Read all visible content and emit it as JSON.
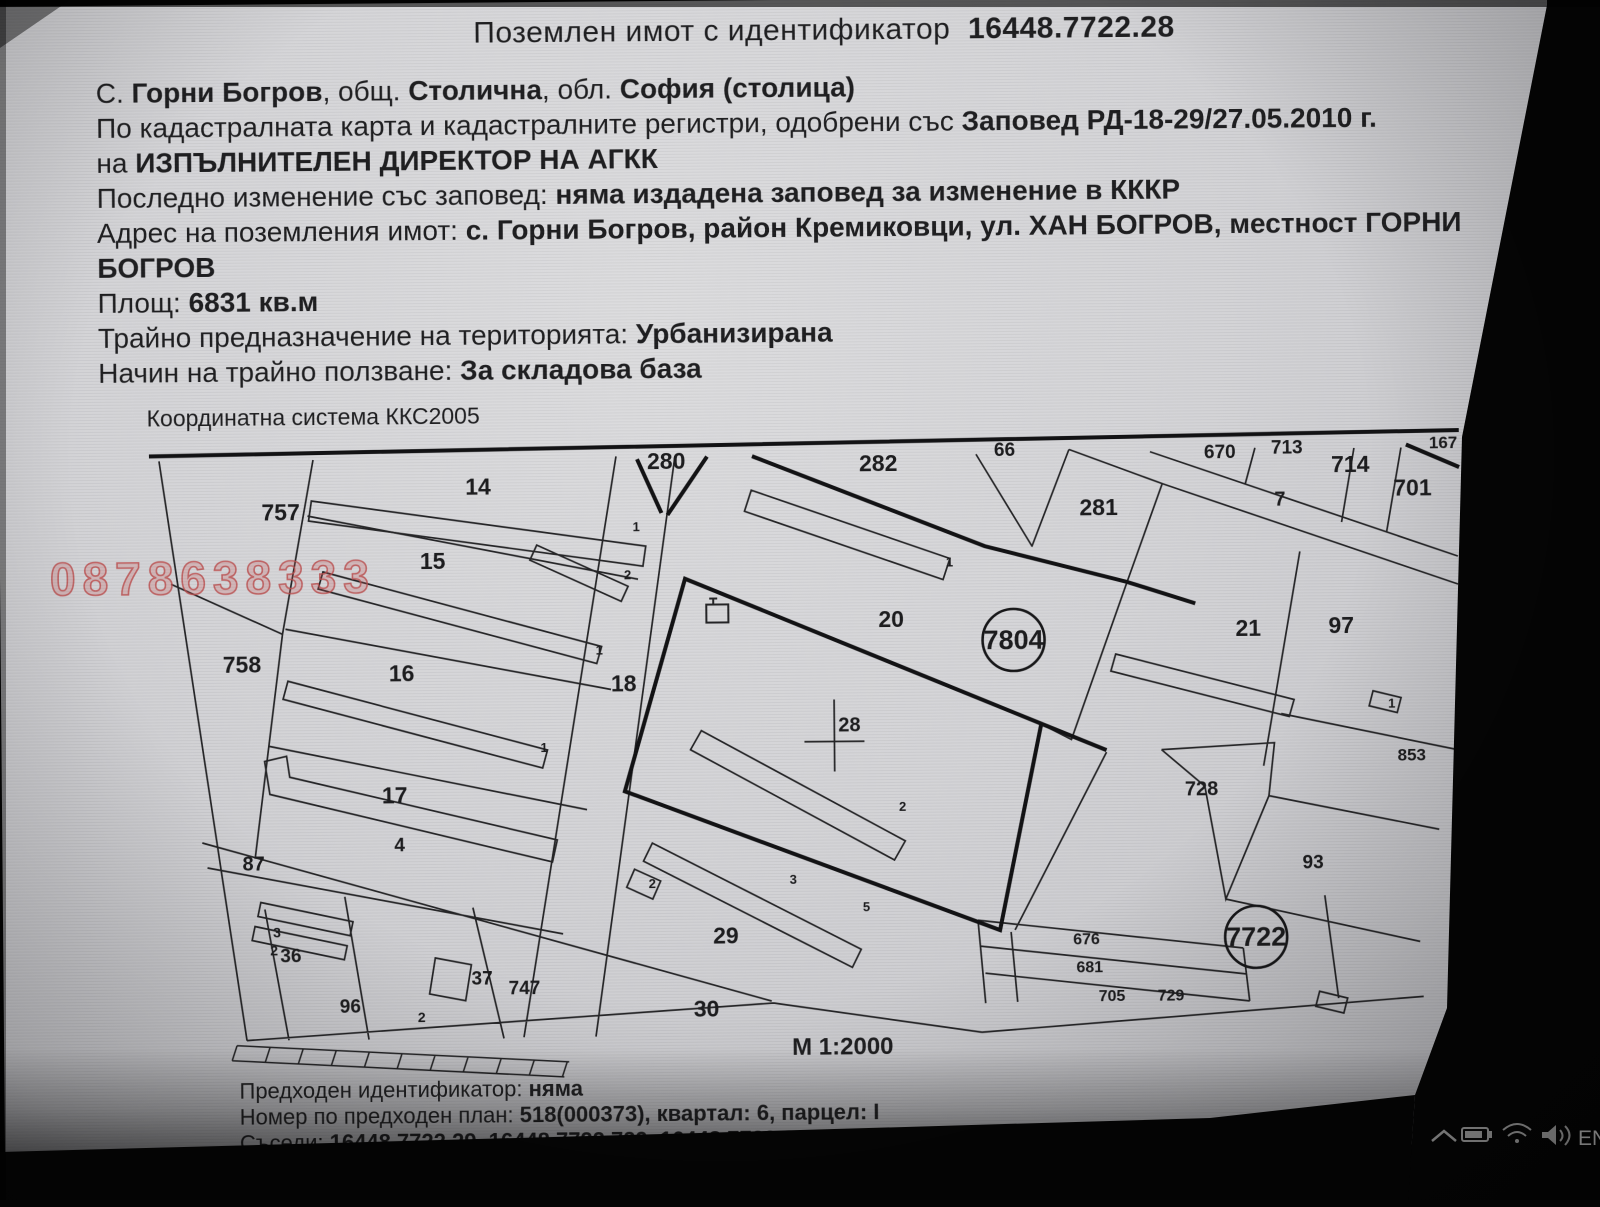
{
  "title": {
    "prefix": "Поземлен имот с  идентификатор",
    "id": "16448.7722.28"
  },
  "header": {
    "lines": [
      {
        "parts": [
          {
            "text": "С. ",
            "bold": false
          },
          {
            "text": "Горни Богров",
            "bold": true
          },
          {
            "text": ", общ. ",
            "bold": false
          },
          {
            "text": "Столична",
            "bold": true
          },
          {
            "text": ", обл. ",
            "bold": false
          },
          {
            "text": "София (столица)",
            "bold": true
          }
        ]
      },
      {
        "parts": [
          {
            "text": "По кадастралната карта и кадастралните регистри, одобрени със ",
            "bold": false
          },
          {
            "text": "Заповед РД-18-29/27.05.2010 г.",
            "bold": true
          }
        ]
      },
      {
        "parts": [
          {
            "text": "на ",
            "bold": false
          },
          {
            "text": "ИЗПЪЛНИТЕЛЕН ДИРЕКТОР НА АГКК",
            "bold": true
          }
        ]
      },
      {
        "parts": [
          {
            "text": "Последно изменение със заповед: ",
            "bold": false
          },
          {
            "text": "няма издадена заповед за изменение в КККР",
            "bold": true
          }
        ]
      },
      {
        "parts": [
          {
            "text": "Адрес на поземления имот: ",
            "bold": false
          },
          {
            "text": "с. Горни Богров, район Кремиковци, ул. ХАН БОГРОВ, местност ГОРНИ",
            "bold": true
          }
        ]
      },
      {
        "parts": [
          {
            "text": "БОГРОВ",
            "bold": true
          }
        ]
      },
      {
        "parts": [
          {
            "text": "Площ: ",
            "bold": false
          },
          {
            "text": "6831 кв.м",
            "bold": true
          }
        ]
      },
      {
        "parts": [
          {
            "text": "Трайно предназначение на територията: ",
            "bold": false
          },
          {
            "text": "Урбанизирана",
            "bold": true
          }
        ]
      },
      {
        "parts": [
          {
            "text": "Начин на трайно ползване: ",
            "bold": false
          },
          {
            "text": "За складова база",
            "bold": true
          }
        ]
      }
    ]
  },
  "map": {
    "coordinate_system": "Координатна система ККС2005",
    "scale_label": "М 1:2000",
    "target_parcel": "28",
    "watermark": {
      "text": "0878638333",
      "color": "#ba4c4c"
    },
    "circled": [
      {
        "t": "7804",
        "x": 1013,
        "y": 642
      },
      {
        "t": "7722",
        "x": 1253,
        "y": 941
      }
    ],
    "labels": [
      {
        "t": "757",
        "x": 262,
        "y": 516
      },
      {
        "t": "14",
        "x": 466,
        "y": 492
      },
      {
        "t": "15",
        "x": 420,
        "y": 566
      },
      {
        "t": "758",
        "x": 222,
        "y": 668
      },
      {
        "t": "16",
        "x": 388,
        "y": 678
      },
      {
        "t": "17",
        "x": 380,
        "y": 800
      },
      {
        "t": "4",
        "x": 392,
        "y": 848,
        "s": 19
      },
      {
        "t": "18",
        "x": 610,
        "y": 690
      },
      {
        "t": "87",
        "x": 240,
        "y": 866,
        "s": 20
      },
      {
        "t": "3",
        "x": 270,
        "y": 933,
        "s": 14
      },
      {
        "t": "2",
        "x": 267,
        "y": 951,
        "s": 14
      },
      {
        "t": "36",
        "x": 277,
        "y": 958,
        "s": 19
      },
      {
        "t": "96",
        "x": 336,
        "y": 1009,
        "s": 19
      },
      {
        "t": "37",
        "x": 468,
        "y": 982,
        "s": 19
      },
      {
        "t": "747",
        "x": 505,
        "y": 992,
        "s": 19
      },
      {
        "t": "2",
        "x": 414,
        "y": 1019,
        "s": 14
      },
      {
        "t": "280",
        "x": 648,
        "y": 468
      },
      {
        "t": "282",
        "x": 860,
        "y": 472
      },
      {
        "t": "66",
        "x": 995,
        "y": 458,
        "s": 19
      },
      {
        "t": "281",
        "x": 1080,
        "y": 518
      },
      {
        "t": "20",
        "x": 878,
        "y": 628
      },
      {
        "t": "28",
        "x": 837,
        "y": 732,
        "s": 20
      },
      {
        "t": "29",
        "x": 710,
        "y": 943
      },
      {
        "t": "30",
        "x": 690,
        "y": 1016
      },
      {
        "t": "670",
        "x": 1205,
        "y": 462,
        "s": 19
      },
      {
        "t": "713",
        "x": 1272,
        "y": 458,
        "s": 19
      },
      {
        "t": "714",
        "x": 1332,
        "y": 477
      },
      {
        "t": "701",
        "x": 1394,
        "y": 501
      },
      {
        "t": "167",
        "x": 1430,
        "y": 454,
        "s": 17
      },
      {
        "t": "7",
        "x": 1275,
        "y": 510,
        "s": 20
      },
      {
        "t": "21",
        "x": 1235,
        "y": 640
      },
      {
        "t": "97",
        "x": 1328,
        "y": 638
      },
      {
        "t": "728",
        "x": 1183,
        "y": 799,
        "s": 20
      },
      {
        "t": "853",
        "x": 1396,
        "y": 766,
        "s": 17
      },
      {
        "t": "93",
        "x": 1300,
        "y": 873,
        "s": 19
      },
      {
        "t": "676",
        "x": 1070,
        "y": 947,
        "s": 16
      },
      {
        "t": "681",
        "x": 1073,
        "y": 975,
        "s": 16
      },
      {
        "t": "705",
        "x": 1095,
        "y": 1004,
        "s": 16
      },
      {
        "t": "729",
        "x": 1154,
        "y": 1004,
        "s": 16
      },
      {
        "t": "1",
        "x": 633,
        "y": 530,
        "s": 13
      },
      {
        "t": "2",
        "x": 624,
        "y": 578,
        "s": 13
      },
      {
        "t": "1",
        "x": 595,
        "y": 653,
        "s": 13
      },
      {
        "t": "1",
        "x": 539,
        "y": 750,
        "s": 13
      },
      {
        "t": "1",
        "x": 946,
        "y": 568,
        "s": 13
      },
      {
        "t": "2",
        "x": 897,
        "y": 812,
        "s": 13
      },
      {
        "t": "3",
        "x": 787,
        "y": 884,
        "s": 13
      },
      {
        "t": "5",
        "x": 860,
        "y": 912,
        "s": 13
      },
      {
        "t": "2",
        "x": 646,
        "y": 887,
        "s": 13
      },
      {
        "t": "1",
        "x": 1387,
        "y": 713,
        "s": 13
      }
    ]
  },
  "footer": {
    "lines": [
      {
        "parts": [
          {
            "text": "Предходен идентификатор: ",
            "bold": false
          },
          {
            "text": "няма",
            "bold": true
          }
        ]
      },
      {
        "parts": [
          {
            "text": "Номер по предходен план: ",
            "bold": false
          },
          {
            "text": "518(000373), квартал: 6, парцел: I",
            "bold": true
          }
        ]
      },
      {
        "parts": [
          {
            "text": "Съседи: ",
            "bold": false
          },
          {
            "text": "16448.7722.29, 16448.7722.729, 16448.7722.21, 16448.7722.20, 16448.7722.18",
            "bold": true
          }
        ]
      }
    ]
  },
  "taskbar": {
    "language": "EN",
    "icons": [
      "chevron-up-icon",
      "battery-icon",
      "wifi-icon",
      "speaker-icon"
    ]
  },
  "colors": {
    "paper": "#d3d3d6",
    "ink": "#1b1b1d",
    "bezel": "#060606",
    "taskbar_icon": "#a8a8a8"
  }
}
